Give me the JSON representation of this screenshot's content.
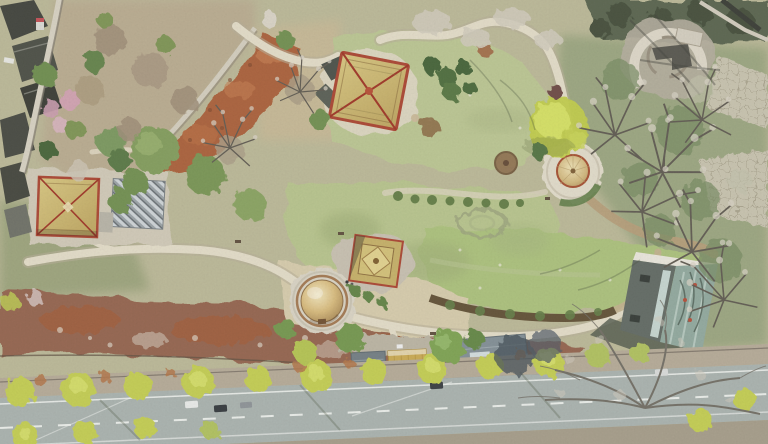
{
  "scene": {
    "label": "Aerial drone photograph of a landscaped heritage park in early spring",
    "setting": "park with pavilions, winding stone footpaths, pale lawns, brown scrub and a tree-lined road along the bottom edge",
    "season_cues": "bare grey trees, russet fallen-leaf slopes, fresh yellow-green street trees"
  },
  "features": {
    "boundary_wall": {
      "label": "grey boundary wall with dark village rooftops outside (north-west corner)"
    },
    "red_scrub_slope": {
      "label": "russet leaf-covered slope with light stone retaining wall"
    },
    "west_pavilion": {
      "label": "square pavilion with ochre pyramidal roof and red eaves"
    },
    "panel_shed": {
      "label": "grey ribbed shed beside the west pavilion"
    },
    "main_pavilion": {
      "label": "large hip-roof pavilion with ochre tiles, red eaves and dark annex"
    },
    "central_pavilion": {
      "label": "stepped square-roof pavilion on a stone terrace"
    },
    "round_pavilion": {
      "label": "round thatched-cone pavilion on a circular stone plaza"
    },
    "dome_pavilion": {
      "label": "golden dome yurt on a circular platform"
    },
    "stone_ruin": {
      "label": "circular stone ruin platform in the north-east corner"
    },
    "glass_building": {
      "label": "modern flat building with reflective glass roof (east side)"
    },
    "entrance_gate": {
      "label": "yellow entrance gate flanked by grey service roofs (south centre)"
    },
    "stone_paths": {
      "label": "winding light stone footpaths linking the pavilions"
    },
    "lawns": {
      "label": "pale spring lawns with faint turf rings"
    },
    "scrub_band": {
      "label": "brown scrub strip with white twiggy shrubs along the road"
    },
    "road": {
      "label": "two-way road with white lane markings, parked cars and willow street trees"
    },
    "yellow_tree": {
      "label": "bright yellow-green tree beside the round pavilion"
    },
    "bare_trees": {
      "label": "leafless grey trees casting long branch shadows (east and south)"
    },
    "grid_terraces": {
      "label": "grid-paved terraces on the eastern slope"
    }
  },
  "palette": {
    "lawn_pale": "#b5c289",
    "lawn_bright": "#a9bf78",
    "dry_grass": "#b9b694",
    "gravel": "#d5caa9",
    "stone_path": "#e2dbc6",
    "scrub_brown": "#916048",
    "leaf_red": "#a85c34",
    "road_grey": "#a7b0ac",
    "road_marking": "#f2f4f0",
    "roof_ochre": "#c9b36a",
    "roof_red_trim": "#a8402c",
    "dome_gold": "#d6b878",
    "dark_roof": "#3c3e37",
    "glass_green": "#8ea69b",
    "tree_dark_green": "#4f6f3b",
    "tree_mid_green": "#7f9a58",
    "tree_yellow_green": "#c2cc4e",
    "bare_tree_grey": "#cfc9ba",
    "blossom_pink": "#cf9fae",
    "entrance_yellow": "#c9a84e"
  }
}
